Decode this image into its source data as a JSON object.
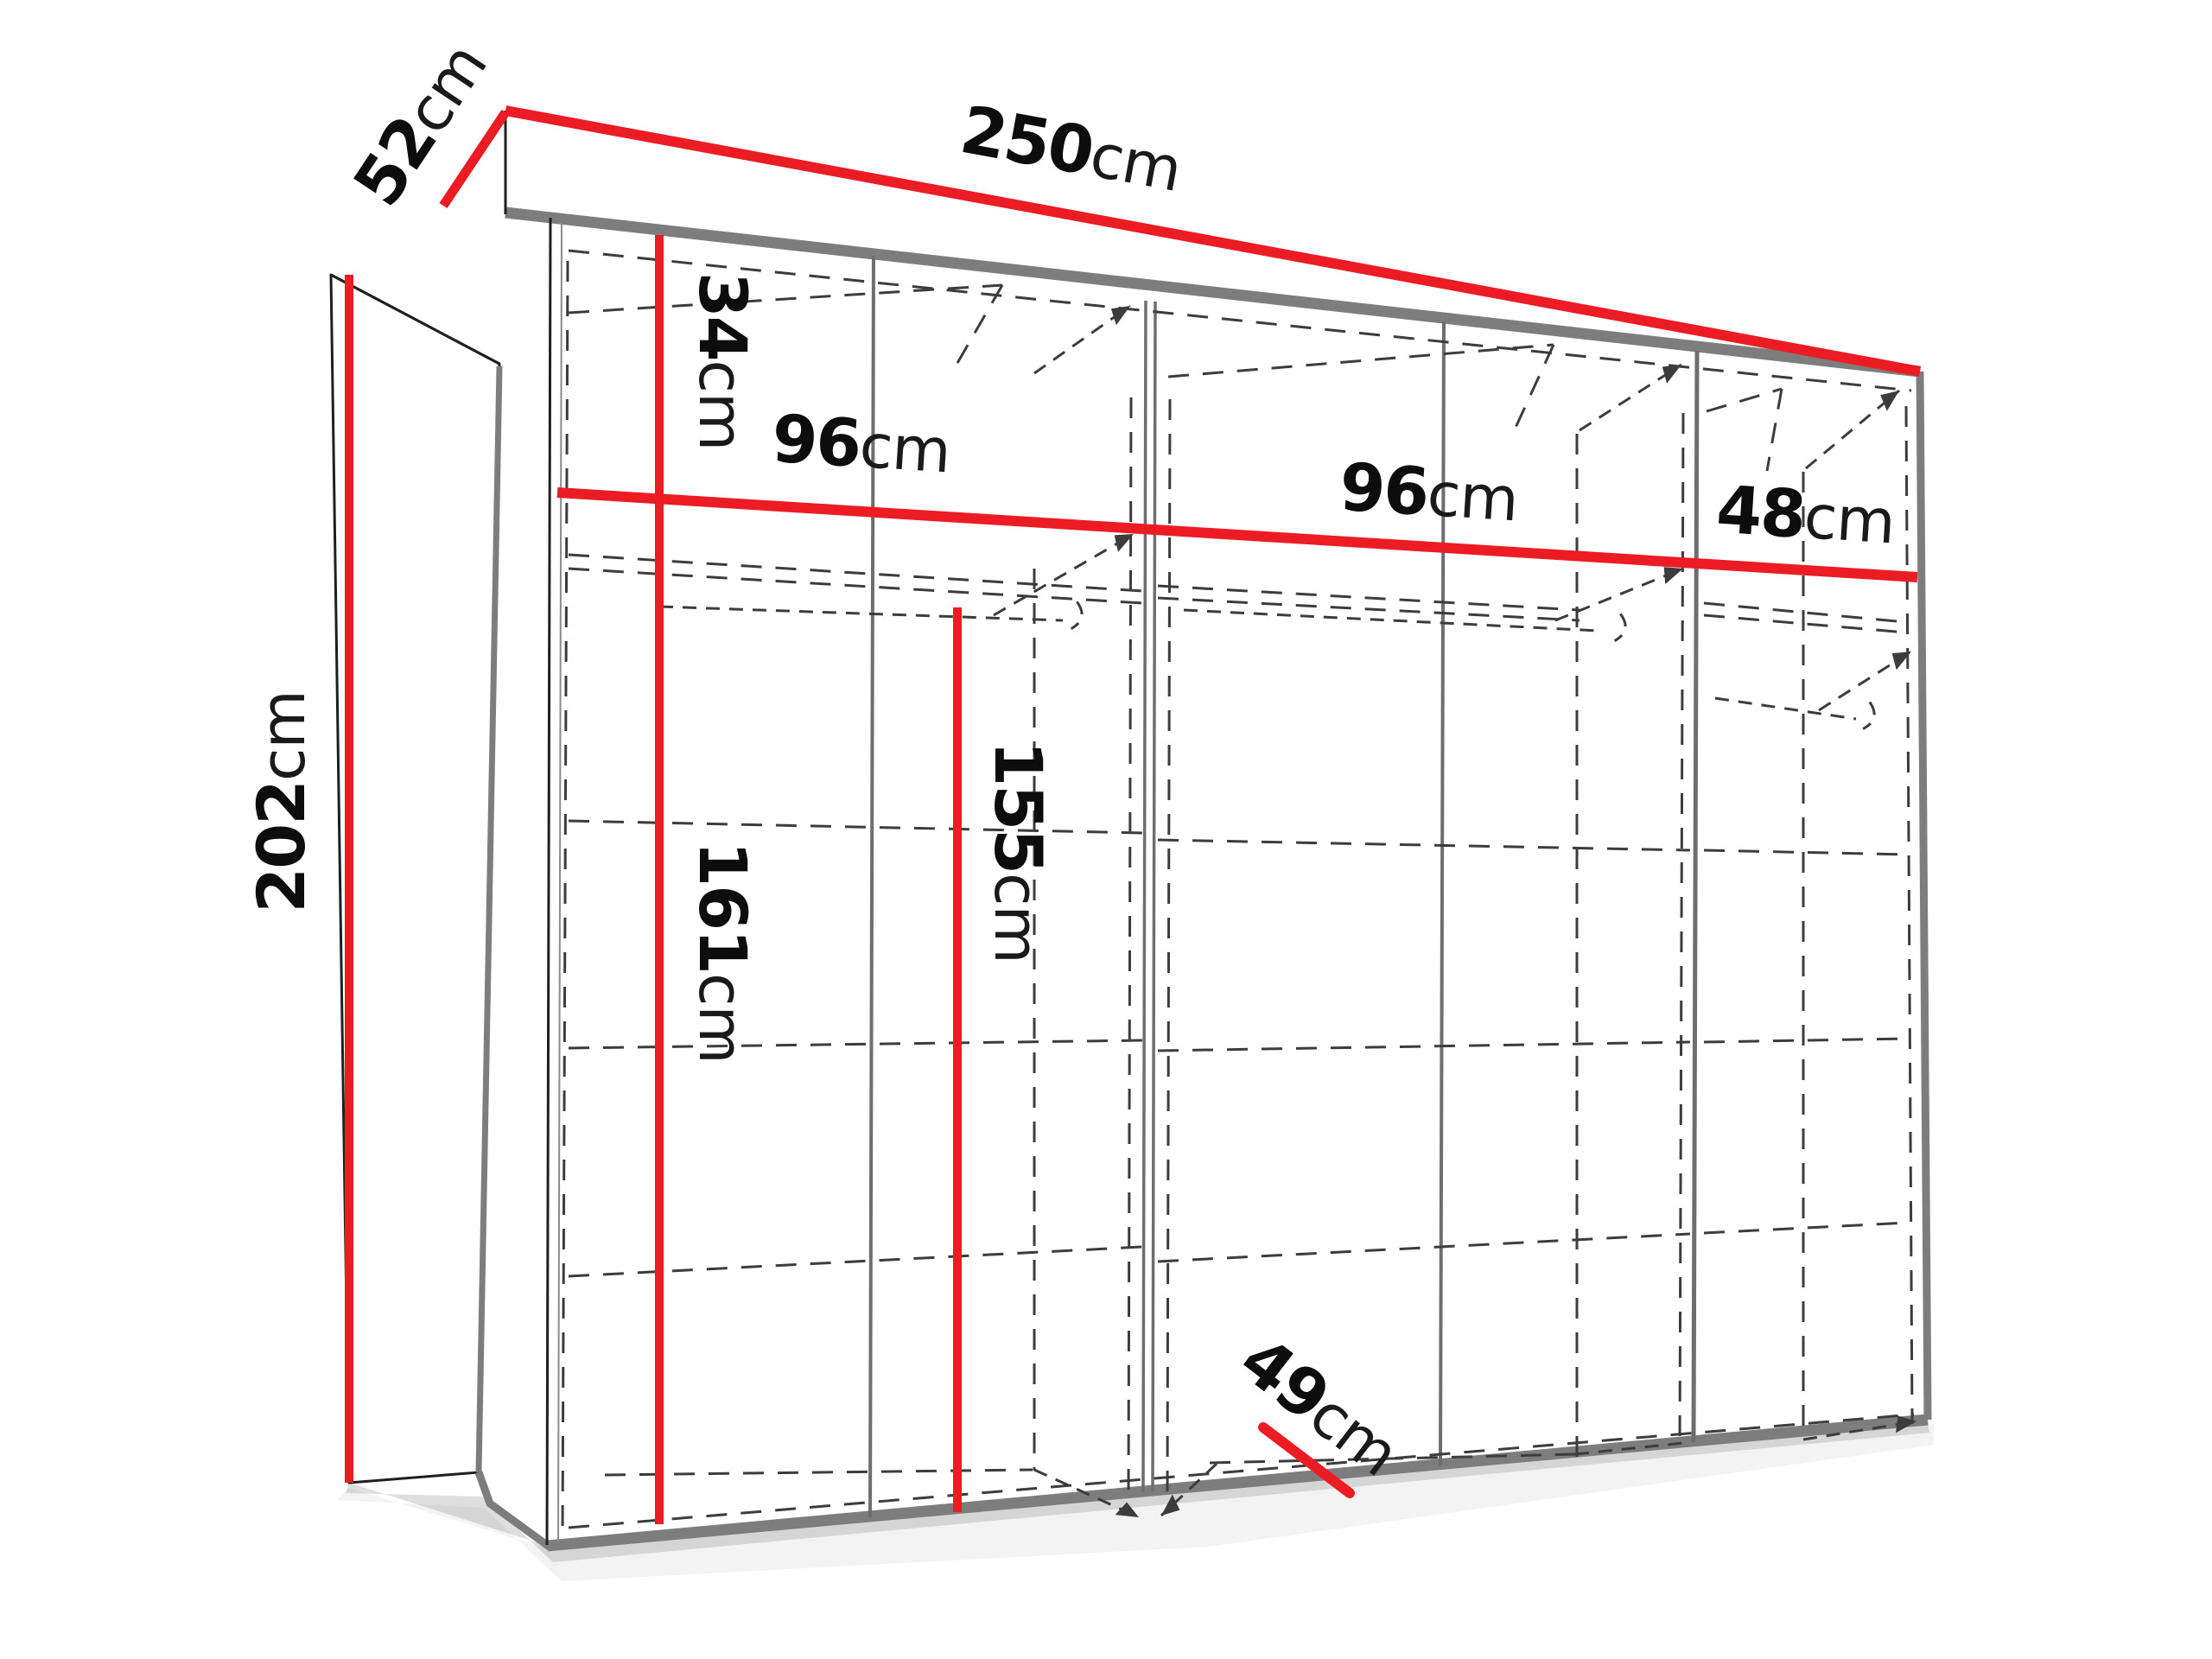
{
  "diagram": {
    "subject": "wardrobe-dimension-diagram",
    "unit": "cm",
    "colors": {
      "dimension_line": "#ec1c24",
      "edge_gray": "#7d7d7d",
      "dashed_line": "#3c3c3c",
      "text": "#0d0d0d",
      "background": "#ffffff"
    },
    "labels": {
      "total_width": {
        "value": "250",
        "unit": "cm"
      },
      "side_depth": {
        "value": "52",
        "unit": "cm"
      },
      "total_height": {
        "value": "202",
        "unit": "cm"
      },
      "top_compartment_height": {
        "value": "34",
        "unit": "cm"
      },
      "left_section_width": {
        "value": "96",
        "unit": "cm"
      },
      "middle_section_width": {
        "value": "96",
        "unit": "cm"
      },
      "right_section_width": {
        "value": "48",
        "unit": "cm"
      },
      "lower_left_interior_height": {
        "value": "161",
        "unit": "cm"
      },
      "hanging_space_height": {
        "value": "155",
        "unit": "cm"
      },
      "interior_depth": {
        "value": "49",
        "unit": "cm"
      }
    }
  }
}
